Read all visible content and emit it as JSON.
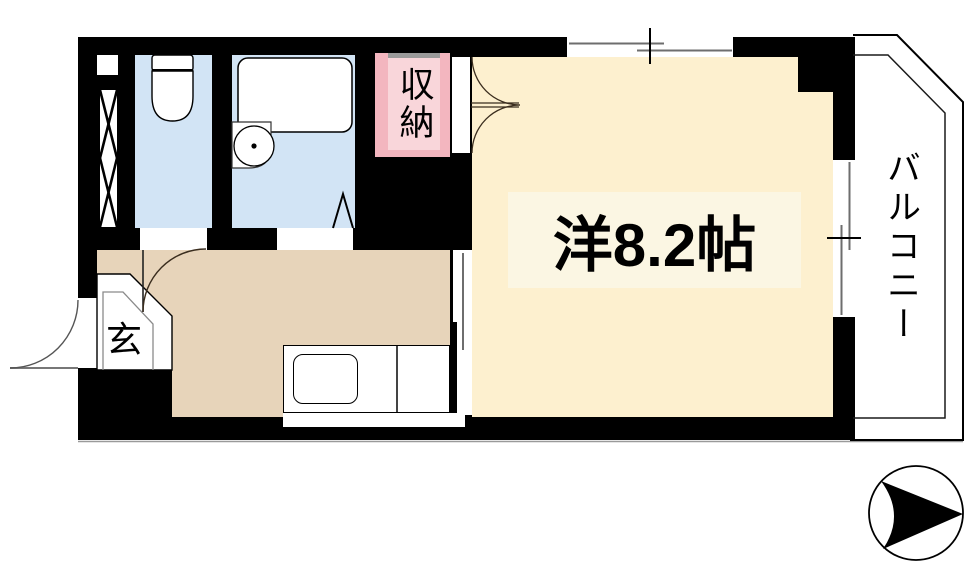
{
  "plan": {
    "rooms": {
      "main_room": {
        "label": "洋8.2帖"
      },
      "storage": {
        "label": "収納"
      },
      "entrance": {
        "label": "玄"
      },
      "balcony": {
        "label": "バルコニー"
      }
    },
    "colors": {
      "wall": "#000000",
      "main_room_fill": "#fdf0cf",
      "main_room_label_bg": "#fbf6e3",
      "kitchen_hall_fill": "#e7d4ba",
      "bathroom_toilet_fill": "#d2e4f5",
      "storage_border_pink": "#f3b6bf",
      "storage_fill_pink": "#f9d6da",
      "window_line_gray": "#6e6e6e"
    },
    "icons": [
      "toilet-icon",
      "bathtub-icon",
      "sink-icon",
      "kitchen-counter-icon",
      "pipe-shaft-icon",
      "door-swing-icon",
      "sliding-window-icon",
      "compass-arrow-icon"
    ]
  }
}
